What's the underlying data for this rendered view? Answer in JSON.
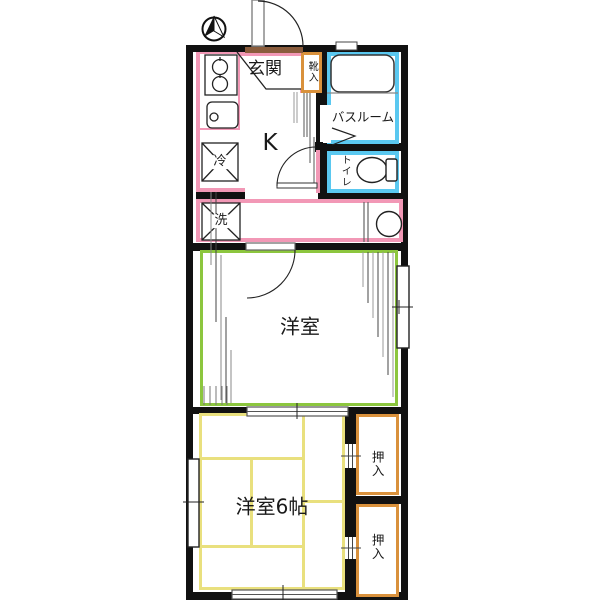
{
  "compass": {
    "name": "north-arrow"
  },
  "colors": {
    "wall": "#111111",
    "kitchen_outline_pink": "#f298b6",
    "bath_outline_blue": "#5ac8f0",
    "room_outline_green": "#8cc63e",
    "closet_outline_orange": "#d9913c",
    "tatami_outline_yellow": "#e9e07e",
    "entrance_threshold_brown": "#8a5c3c"
  },
  "rooms": {
    "kitchen": {
      "label": "K"
    },
    "entrance": {
      "label": "玄関"
    },
    "shoe_cabinet": {
      "label": "靴入"
    },
    "bathroom": {
      "label": "バスルーム"
    },
    "toilet": {
      "label": "トイレ"
    },
    "refrigerator": {
      "label": "冷"
    },
    "washer": {
      "label": "洗"
    },
    "western_room": {
      "label": "洋室"
    },
    "western_room_6": {
      "label": "洋室6帖"
    },
    "closet_upper": {
      "label": "押入"
    },
    "closet_lower": {
      "label": "押入"
    }
  }
}
